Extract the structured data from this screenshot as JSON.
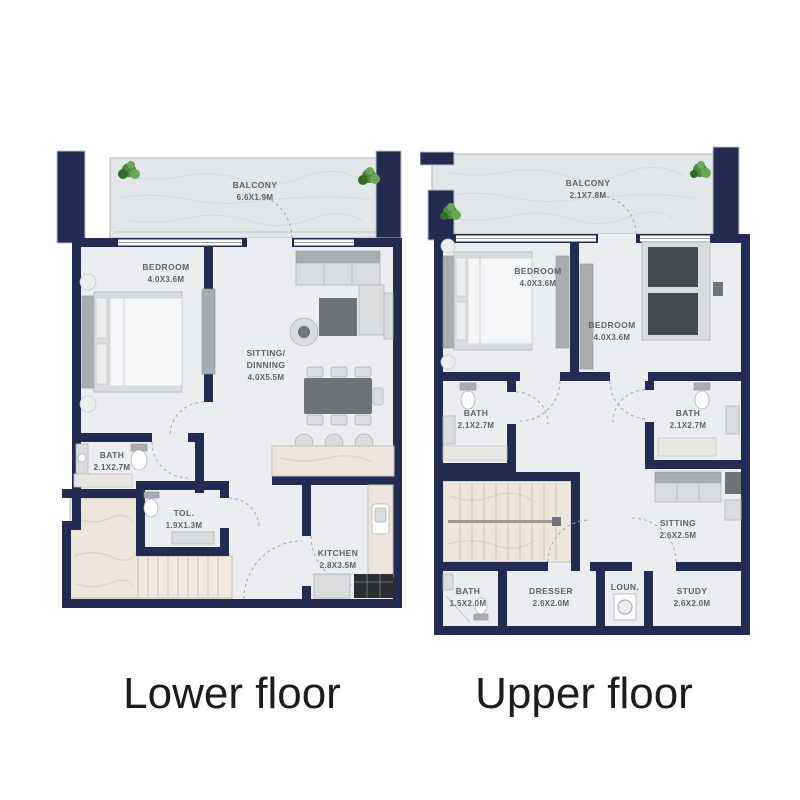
{
  "colors": {
    "wall": "#232b52",
    "floor": "#ebedf0",
    "balcony_floor": "#e4e7ea",
    "marble": "#ece6dd",
    "furniture_dark": "#6f7276",
    "bed_dark": "#45484c",
    "plant_green": "#4c8a3f",
    "room_label_text": "#5a6170",
    "caption_text": "#1c1c1c"
  },
  "captions": {
    "lower": "Lower floor",
    "upper": "Upper floor"
  },
  "lower": {
    "rooms": [
      {
        "name": "BALCONY",
        "dims": "6.6X1.9M"
      },
      {
        "name": "BEDROOM",
        "dims": "4.0X3.6M"
      },
      {
        "name": "SITTING/",
        "name2": "DINNING",
        "dims": "4.0X5.5M"
      },
      {
        "name": "BATH",
        "dims": "2.1X2.7M"
      },
      {
        "name": "TOL.",
        "dims": "1.9X1.3M"
      },
      {
        "name": "KITCHEN",
        "dims": "2.8X3.5M"
      }
    ]
  },
  "upper": {
    "rooms": [
      {
        "name": "BALCONY",
        "dims": "2.1X7.8M"
      },
      {
        "name": "BEDROOM",
        "dims": "4.0X3.6M"
      },
      {
        "name": "BEDROOM",
        "dims": "4.0X3.6M"
      },
      {
        "name": "BATH",
        "dims": "2.1X2.7M"
      },
      {
        "name": "BATH",
        "dims": "2.1X2.7M"
      },
      {
        "name": "SITTING",
        "dims": "2.6X2.5M"
      },
      {
        "name": "BATH",
        "dims": "1.5X2.0M"
      },
      {
        "name": "DRESSER",
        "dims": "2.6X2.0M"
      },
      {
        "name": "LOUN."
      },
      {
        "name": "STUDY",
        "dims": "2.6X2.0M"
      }
    ]
  }
}
